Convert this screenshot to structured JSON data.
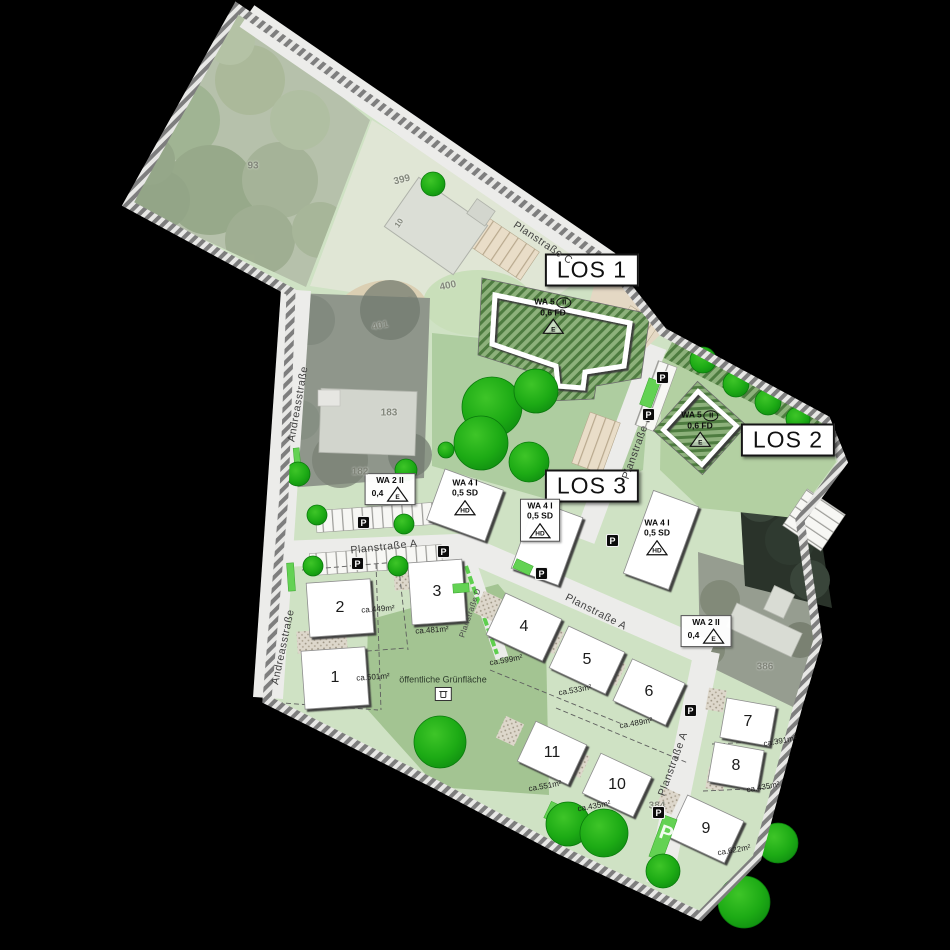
{
  "los": [
    {
      "label": "LOS 1"
    },
    {
      "label": "LOS 2"
    },
    {
      "label": "LOS 3"
    }
  ],
  "zones": [
    {
      "use": "WA 5",
      "height": "II",
      "value": "0,6 FD",
      "house": "E"
    },
    {
      "use": "WA 5",
      "height": "II",
      "value": "0,6 FD",
      "house": "E"
    },
    {
      "use": "WA 2 II",
      "value": "0,4",
      "house": "E"
    },
    {
      "use": "WA 4 I",
      "value": "0,5 SD",
      "house": "HD"
    },
    {
      "use": "WA 4 I",
      "value": "0,5 SD",
      "house": "HD"
    },
    {
      "use": "WA 4 I",
      "value": "0,5 SD",
      "house": "HD"
    },
    {
      "use": "WA 2 II",
      "value": "0,4",
      "house": "E"
    }
  ],
  "plots": [
    {
      "number": "1",
      "area": "ca.501m²"
    },
    {
      "number": "2",
      "area": "ca.449m²"
    },
    {
      "number": "3",
      "area": "ca.481m²"
    },
    {
      "number": "4",
      "area": "ca.599m²"
    },
    {
      "number": "5",
      "area": "ca.533m²"
    },
    {
      "number": "6",
      "area": "ca.489m²"
    },
    {
      "number": "7",
      "area": "ca.391m²"
    },
    {
      "number": "8",
      "area": "ca.435m²"
    },
    {
      "number": "9",
      "area": "ca.622m²"
    },
    {
      "number": "10",
      "area": "ca.435m²"
    },
    {
      "number": "11",
      "area": "ca.551m²"
    }
  ],
  "streets": {
    "a": "Planstraße A",
    "b": "Planstraße B",
    "c": "Planstraße C",
    "d": "Planstraße D",
    "andreas": "Andreasstraße"
  },
  "parcels": {
    "n399": "399",
    "n400": "400",
    "n401": "401",
    "n183": "183",
    "n182": "182",
    "n386": "386",
    "n384": "384",
    "n93": "93",
    "house10": "10"
  },
  "green_area": {
    "label": "öffentliche Grünfläche"
  },
  "symbols": {
    "parking": "P"
  },
  "colors": {
    "background": "#000000",
    "plan_green": "#cfe2c4",
    "lawn": "#abcb9b",
    "zone_hatch": "#86ab74",
    "street": "#ececea",
    "tree": "#1ea91c",
    "building": "#ffffff"
  }
}
